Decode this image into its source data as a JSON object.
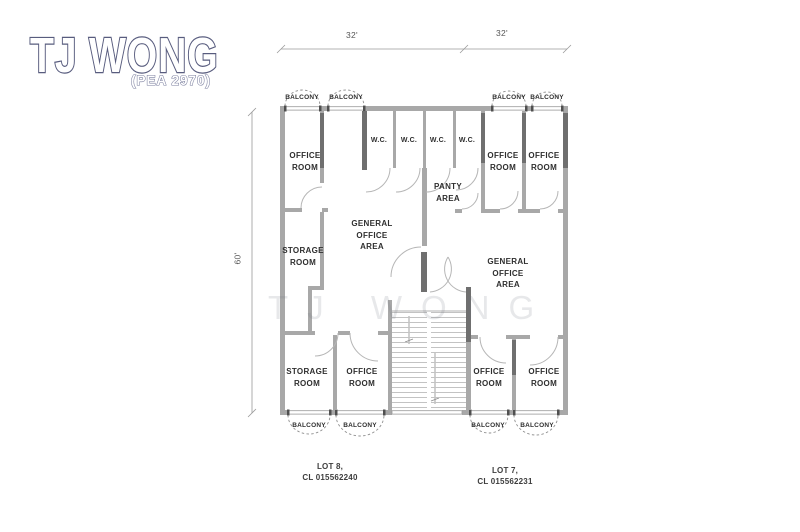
{
  "logo": {
    "title": "TJ WONG",
    "registration": "(PEA 2970)"
  },
  "dimensions": {
    "top_left": "32'",
    "top_right": "32'",
    "side": "60'"
  },
  "watermark": "TJ WONG",
  "labels": {
    "balcony": "BALCONY",
    "wc": "W.C.",
    "office_room": "OFFICE\nROOM",
    "storage_room": "STORAGE\nROOM",
    "panty_area": "PANTY\nAREA",
    "general_office_area": "GENERAL\nOFFICE\nAREA"
  },
  "lots": {
    "lot8": "LOT 8,\nCL 015562240",
    "lot7": "LOT 7,\nCL 015562231"
  },
  "colors": {
    "wall": "#a8a8a8",
    "wall_dark": "#6f6f6f",
    "logo_outline": "#585c7e"
  }
}
